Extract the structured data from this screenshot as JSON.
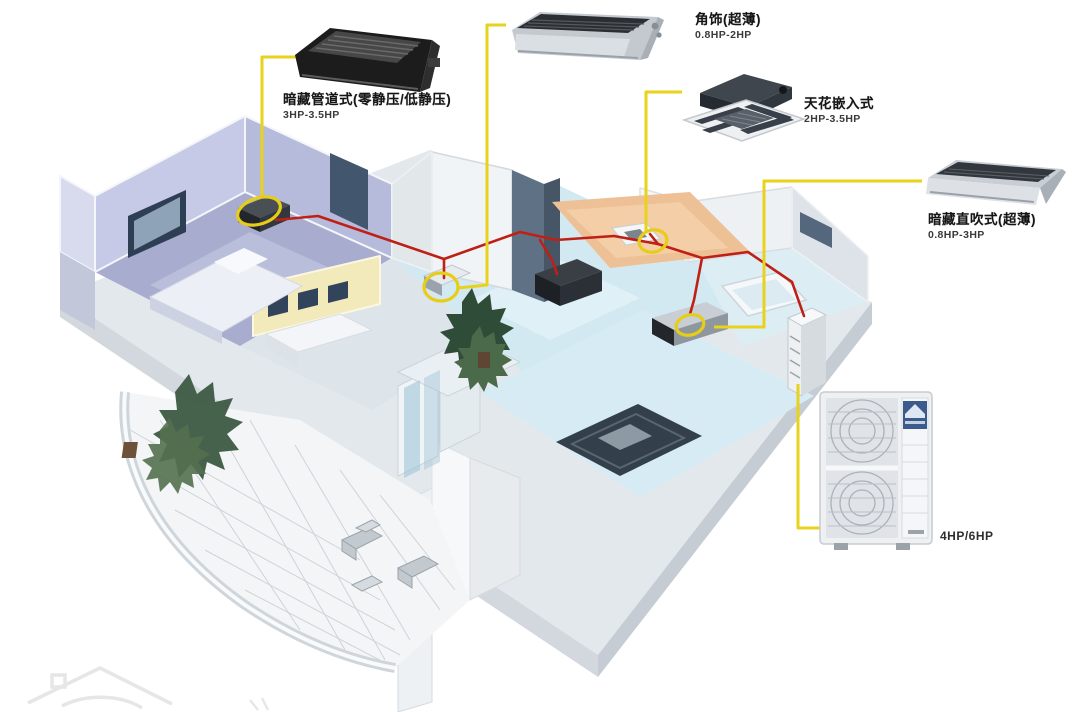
{
  "diagram": {
    "description": "Isometric cutaway apartment illustration showing a household central air-conditioning (VRV) system: four indoor unit types connected by red refrigerant piping to an outdoor unit, with yellow callout lines to product photos",
    "background_color": "#ffffff"
  },
  "colors": {
    "callout_yellow": "#e9d21b",
    "pipe_red": "#bf2015",
    "highlight_ring": "#e6cd18",
    "bedroom_purple": "#b3b8d9",
    "wall_yellow": "#f2eaba",
    "ceiling_orange": "#eec096",
    "floor_cyan": "#d2e9f1",
    "outdoor_badge_blue": "#3c5a8c"
  },
  "products": [
    {
      "id": "concealed-duct",
      "icon": "concealed-duct-unit-photo",
      "label": "暗藏管道式(零静压/低静压)",
      "hp": "3HP-3.5HP"
    },
    {
      "id": "slim-ceiling",
      "icon": "slim-ceiling-duct-unit-photo",
      "label": "角饰(超薄)",
      "hp": "0.8HP-2HP"
    },
    {
      "id": "cassette",
      "icon": "ceiling-cassette-unit-photo",
      "label": "天花嵌入式",
      "hp": "2HP-3.5HP"
    },
    {
      "id": "slim-concealed",
      "icon": "slim-concealed-unit-photo",
      "label": "暗藏直吹式(超薄)",
      "hp": "0.8HP-3HP"
    },
    {
      "id": "outdoor-unit",
      "icon": "outdoor-unit-photo",
      "label": "",
      "hp": "4HP/6HP"
    }
  ],
  "watermark": {
    "icon": "house-logo-watermark"
  }
}
